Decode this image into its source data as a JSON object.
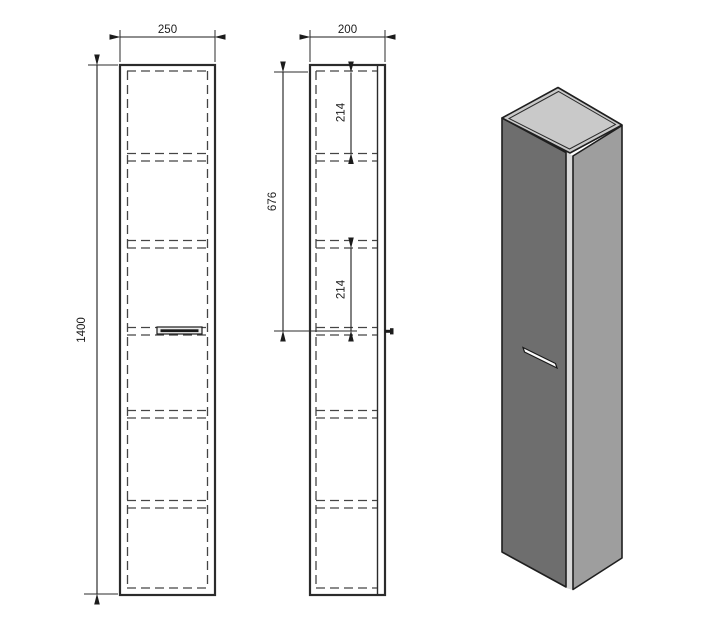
{
  "dims": {
    "front_width": "250",
    "front_height": "1400",
    "side_depth": "200",
    "top_shelf_spacing": "214",
    "handle_offset": "676",
    "mid_shelf_spacing": "214"
  },
  "colors": {
    "line": "#2b2b2b",
    "top_face": "#c9c9c9",
    "front_face": "#6e6e6e",
    "side_face": "#9e9e9e",
    "panel_gap": "#d8d8d8",
    "handle": "#fafafa"
  }
}
